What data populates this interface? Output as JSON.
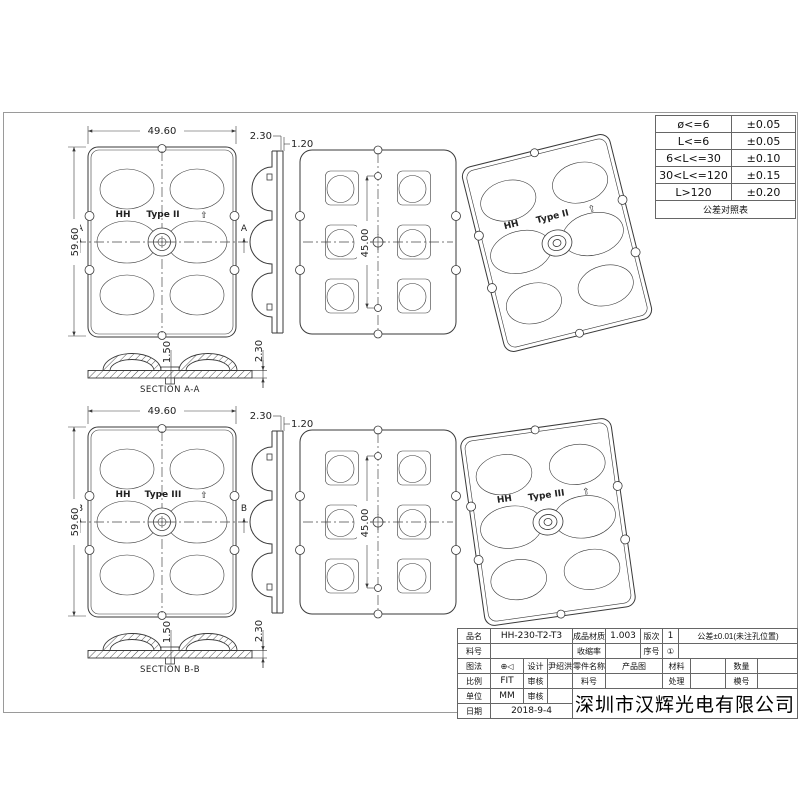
{
  "sheet": {
    "company": "深圳市汉辉光电有限公司"
  },
  "tolerance_table": {
    "rows": [
      {
        "range": "ø<=6",
        "tol": "±0.05"
      },
      {
        "range": "L<=6",
        "tol": "±0.05"
      },
      {
        "range": "6<L<=30",
        "tol": "±0.10"
      },
      {
        "range": "30<L<=120",
        "tol": "±0.15"
      },
      {
        "range": "L>120",
        "tol": "±0.20"
      }
    ],
    "footer": "公差对照表"
  },
  "title_block": {
    "part_name_label": "品名",
    "part_name": "HH-230-T2-T3",
    "material_label": "成品材质",
    "material": "1.003",
    "rev_label": "版次",
    "rev": "1",
    "tol_note": "公差±0.01(未注孔位置)",
    "stock_label": "料号",
    "stock": "",
    "shrink_label": "收缩率",
    "shrink": "",
    "seq_label": "序号",
    "seq": "①",
    "proj_label": "图法",
    "proj_symbols": "⊕◁",
    "design_label": "设计",
    "designer": "尹绍洪",
    "component_label": "零件名称",
    "component": "产品图",
    "mat2_label": "材料",
    "mat2": "",
    "qty_label": "数量",
    "qty": "",
    "scale_label": "比例",
    "scale": "FIT",
    "check_label": "审核",
    "check1": "",
    "check2": "",
    "stock2_label": "料号",
    "stock2": "",
    "treat_label": "处理",
    "treat": "",
    "mold_label": "模号",
    "mold": "",
    "unit_label": "单位",
    "unit": "MM",
    "date_label": "日期",
    "date": "2018-9-4"
  },
  "views": {
    "top": {
      "front": {
        "dim_width": "49.60",
        "dim_height": "59.60",
        "brand": "HH",
        "type_label": "Type II",
        "arrow": "⇧",
        "section_letter": "A"
      },
      "side": {
        "dim_thickness": "2.30",
        "dim_flange": "1.20"
      },
      "plan": {
        "dim_pitch": "45.00"
      },
      "iso": {
        "brand": "HH",
        "type_label": "Type II",
        "arrow": "⇧"
      },
      "section": {
        "label": "SECTION A-A",
        "dim_center": "1.50",
        "dim_total": "2.30"
      }
    },
    "bot": {
      "front": {
        "dim_width": "49.60",
        "dim_height": "59.60",
        "brand": "HH",
        "type_label": "Type III",
        "arrow": "⇧",
        "section_letter": "B"
      },
      "side": {
        "dim_thickness": "2.30",
        "dim_flange": "1.20"
      },
      "plan": {
        "dim_pitch": "45.00"
      },
      "iso": {
        "brand": "HH",
        "type_label": "Type III",
        "arrow": "⇧"
      },
      "section": {
        "label": "SECTION B-B",
        "dim_center": "1.50",
        "dim_total": "2.30"
      }
    }
  }
}
